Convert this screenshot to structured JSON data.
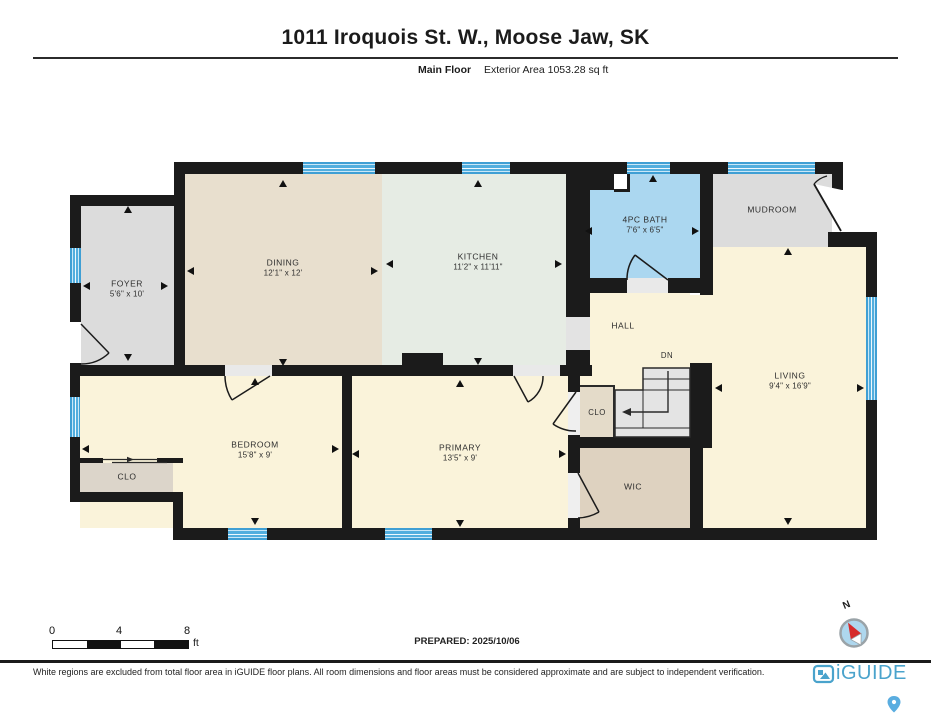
{
  "header": {
    "title": "1011 Iroquois St. W., Moose Jaw, SK",
    "floor_label": "Main Floor",
    "area_label": "Exterior Area 1053.28 sq ft"
  },
  "rooms": {
    "foyer": {
      "name": "FOYER",
      "dims": "5'6\" x 10'"
    },
    "dining": {
      "name": "DINING",
      "dims": "12'1\" x 12'"
    },
    "kitchen": {
      "name": "KITCHEN",
      "dims": "11'2\" x 11'11\""
    },
    "bath": {
      "name": "4PC BATH",
      "dims": "7'6\" x 6'5\""
    },
    "mudroom": {
      "name": "MUDROOM"
    },
    "hall": {
      "name": "HALL"
    },
    "stairs": {
      "name": "DN"
    },
    "clo_hall": {
      "name": "CLO"
    },
    "wic": {
      "name": "WIC"
    },
    "living": {
      "name": "LIVING",
      "dims": "9'4\" x 16'9\""
    },
    "bedroom": {
      "name": "BEDROOM",
      "dims": "15'8\" x 9'"
    },
    "clo_bedroom": {
      "name": "CLO"
    },
    "primary": {
      "name": "PRIMARY",
      "dims": "13'5\" x 9'"
    }
  },
  "footer": {
    "scale": {
      "ticks": [
        "0",
        "4",
        "8"
      ],
      "unit": "ft"
    },
    "prepared_label": "PREPARED: 2025/10/06",
    "compass_label": "N",
    "brand": "iGUIDE",
    "disclaimer": "White regions are excluded from total floor area in iGUIDE floor plans. All room dimensions and floor areas must be considered approximate and are subject to independent verification."
  },
  "colors": {
    "wall": "#1b1b1b",
    "window_blue": "#3f9fd4",
    "bath_blue": "#abd7f0",
    "room_cream": "#faf3da",
    "dining_tan": "#e8dfce",
    "kitchen_green": "#e6ece4",
    "room_gray": "#dcdcdc",
    "closet_taupe": "#ded2c0",
    "brand_blue": "#4aa3cc",
    "compass_red": "#d62b2b"
  }
}
